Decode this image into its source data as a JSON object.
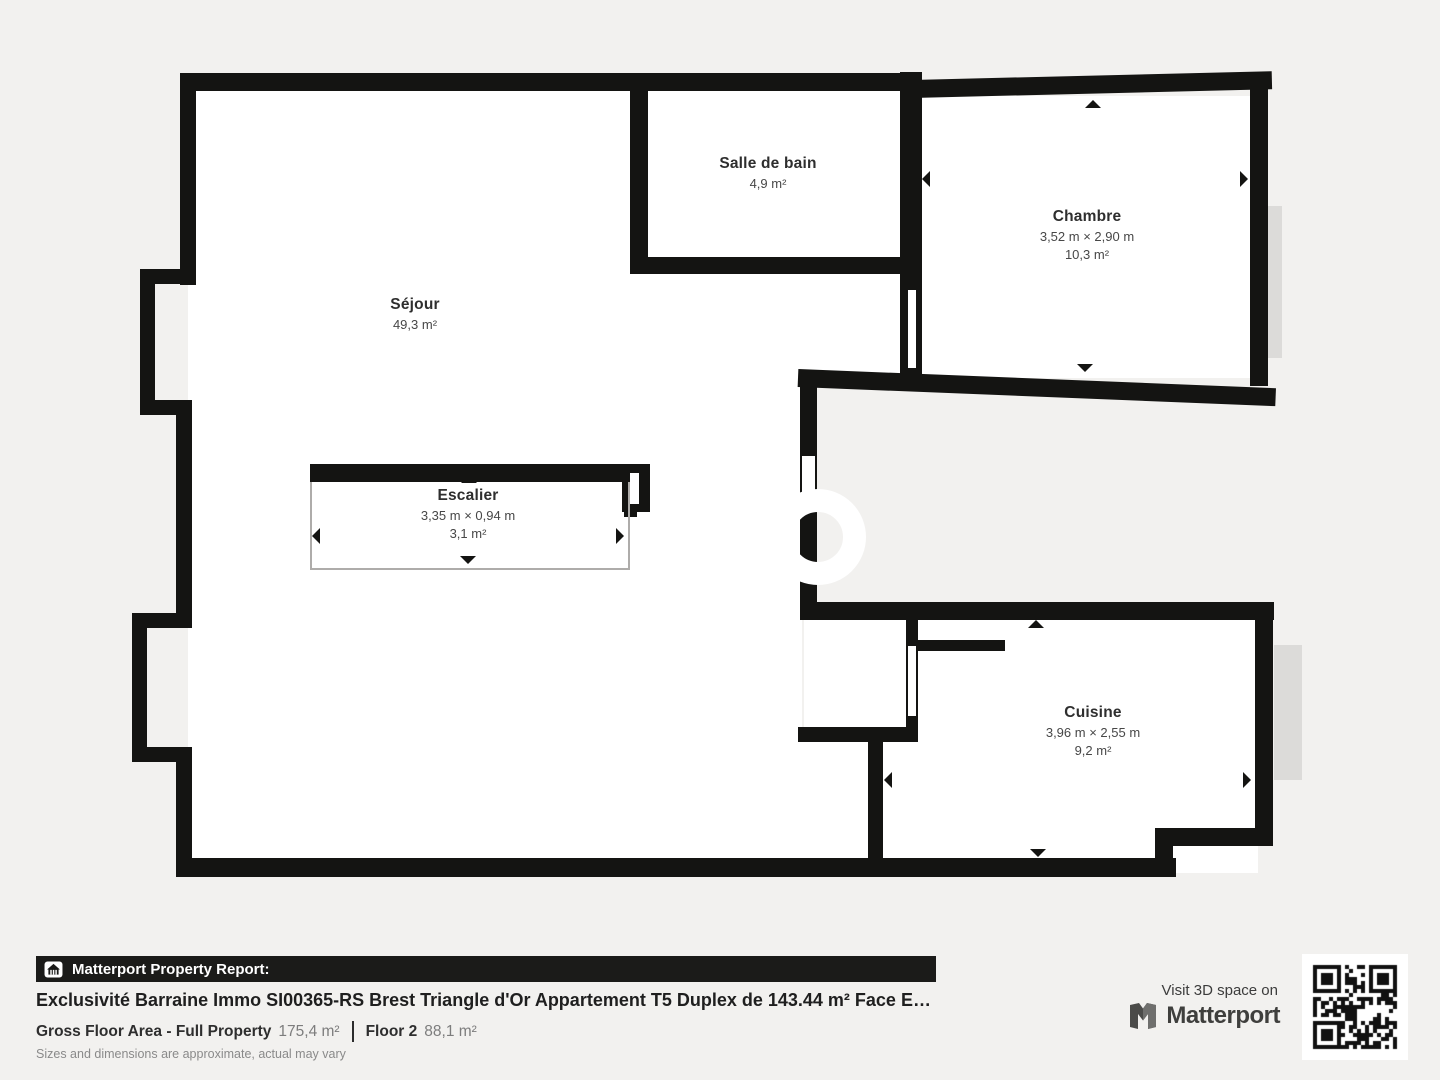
{
  "plan": {
    "floor_label": "Floor 2",
    "rooms": [
      {
        "id": "sejour",
        "name": "Séjour",
        "area": "49,3 m²"
      },
      {
        "id": "salle_de_bain",
        "name": "Salle de bain",
        "area": "4,9 m²"
      },
      {
        "id": "chambre",
        "name": "Chambre",
        "dims": "3,52 m × 2,90 m",
        "area": "10,3 m²"
      },
      {
        "id": "escalier",
        "name": "Escalier",
        "dims": "3,35 m × 0,94 m",
        "area": "3,1 m²"
      },
      {
        "id": "cuisine",
        "name": "Cuisine",
        "dims": "3,96 m × 2,55 m",
        "area": "9,2 m²"
      }
    ]
  },
  "footer": {
    "report_label": "Matterport Property Report:",
    "title": "Exclusivité Barraine Immo SI00365-RS Brest Triangle d'Or Appartement T5 Duplex de 143.44 m² Face E…",
    "gross_label": "Gross Floor Area - Full Property",
    "gross_value": "175,4 m²",
    "floor_label": "Floor 2",
    "floor_value": "88,1 m²",
    "disclaimer": "Sizes and dimensions are approximate, actual may vary",
    "visit_label": "Visit 3D space on",
    "brand": "Matterport"
  },
  "icons": {
    "report_icon": "building-icon",
    "brand_icon": "matterport-logo",
    "qr": "qr-code"
  },
  "colors": {
    "background": "#f2f1ef",
    "wall": "#141412",
    "room_fill": "#ffffff",
    "outside_shadow": "#dcdbd9",
    "footer_bar": "#1b1b19",
    "text_dark": "#222222",
    "text_gray": "#7d7d7d"
  }
}
